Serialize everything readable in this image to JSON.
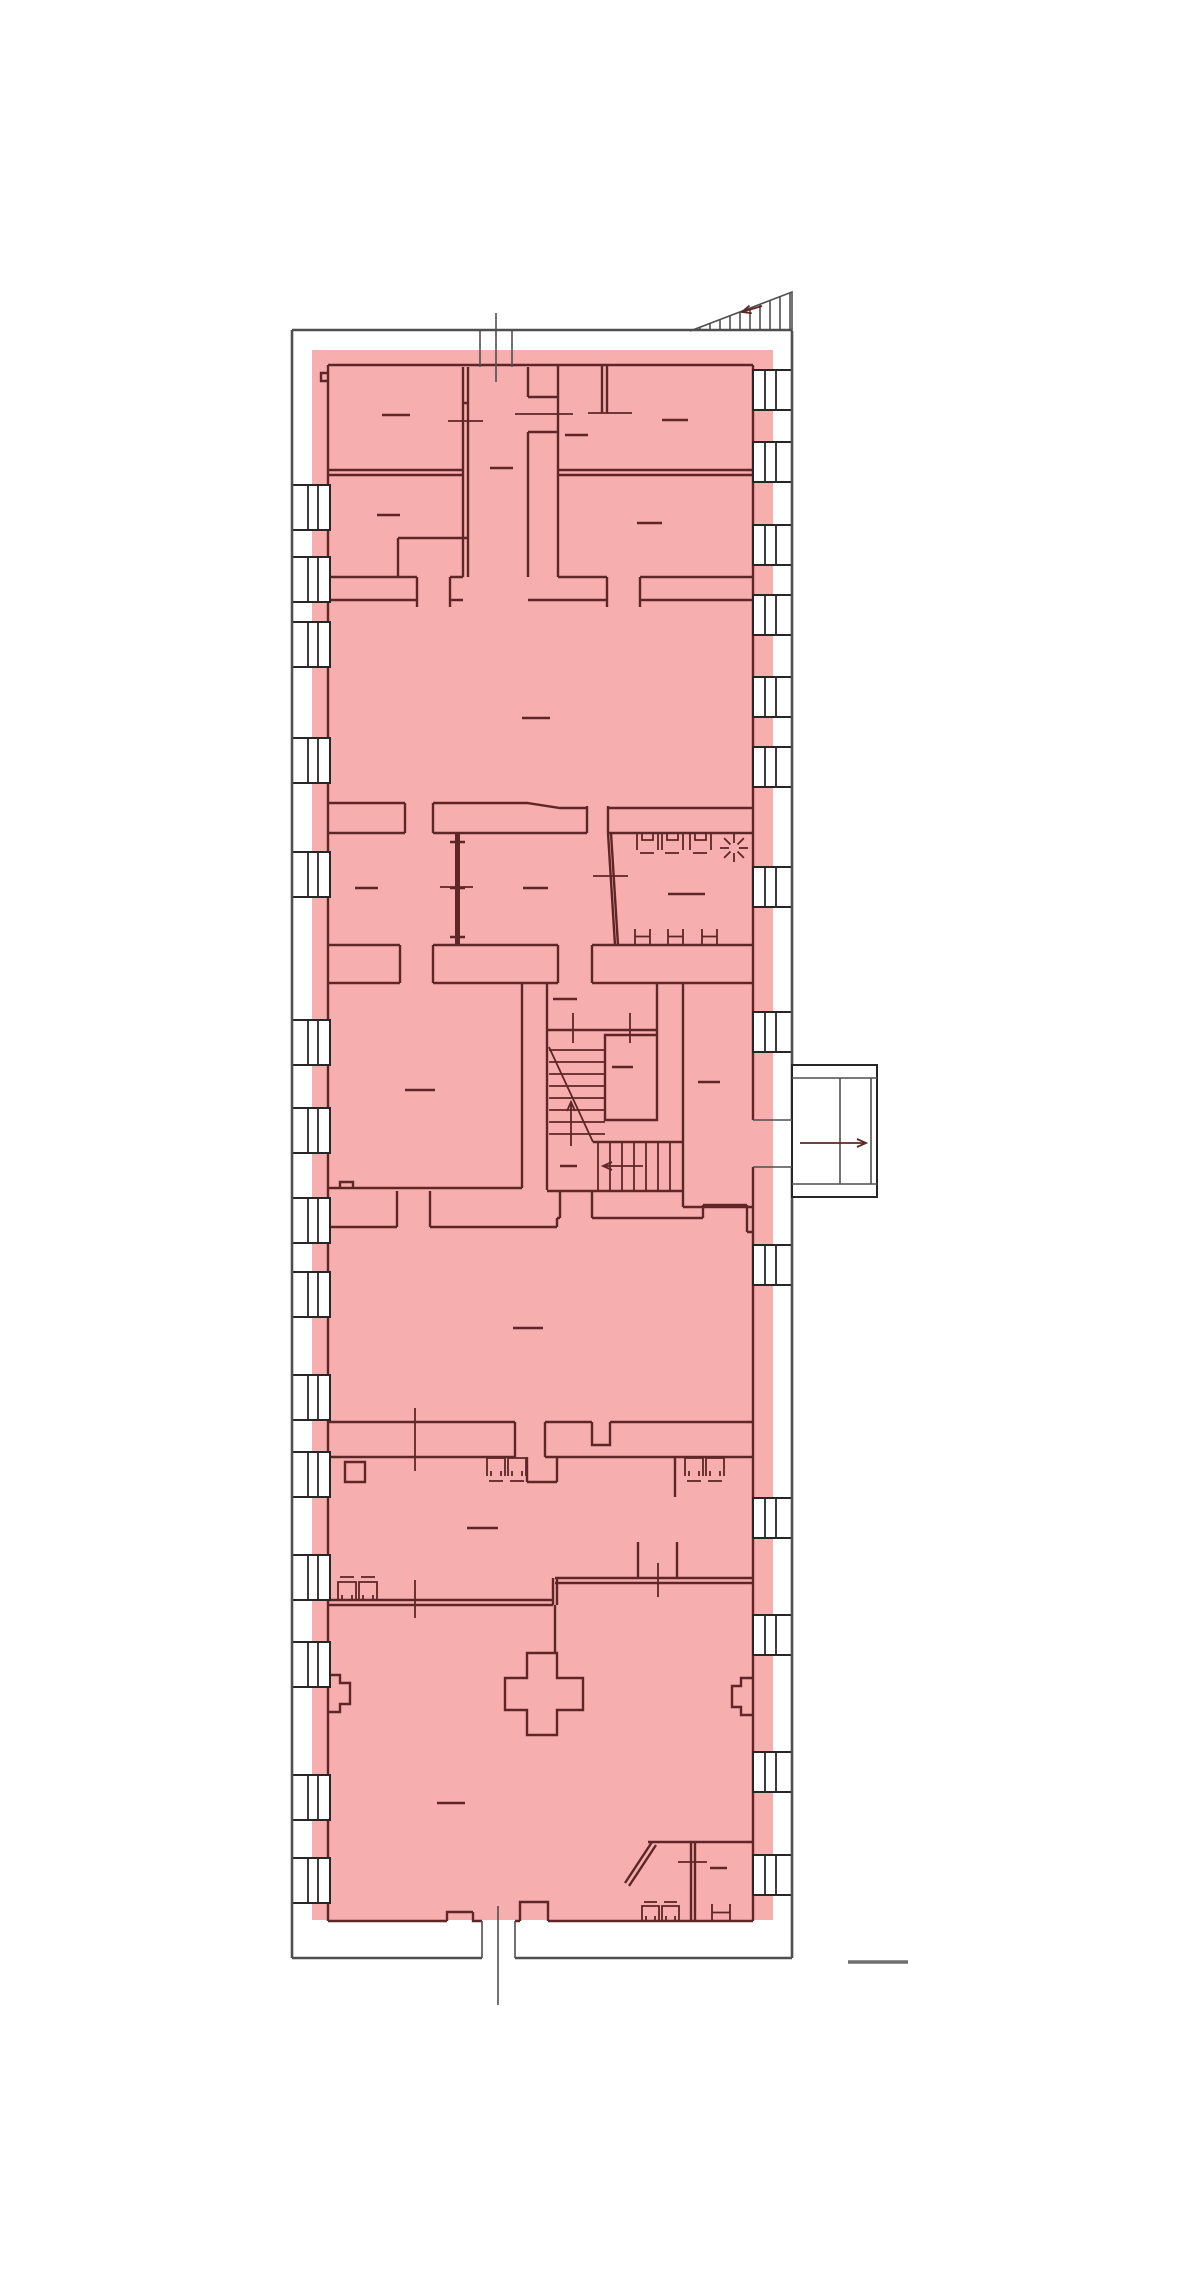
{
  "document": {
    "type": "architectural-floor-plan",
    "description": "single-storey floor plan with highlighted (selected) floor area, no readable text labels",
    "visible_text": []
  },
  "colors": {
    "bg": "#ffffff",
    "highlight": "#f7aeae",
    "wall": "#5e2626",
    "outline": "#4f4f4f",
    "win_line": "#262626",
    "scale_line": "#6e6e6e"
  },
  "highlight_overlay": {
    "x": 312,
    "y": 350,
    "w": 461,
    "h": 1570
  },
  "windows": {
    "left": {
      "x": 292,
      "w": 38,
      "h": 45,
      "mullions": [
        308,
        318
      ],
      "tops": [
        485,
        557,
        622,
        738,
        852,
        1020,
        1108,
        1198,
        1272,
        1375,
        1452,
        1555,
        1642,
        1775,
        1858
      ]
    },
    "right": {
      "x": 753,
      "w": 39,
      "h": 40,
      "mullions": [
        765,
        776
      ],
      "tops": [
        370,
        442,
        525,
        595,
        677,
        747,
        867,
        1012,
        1245,
        1498,
        1615,
        1752,
        1855
      ]
    }
  },
  "room_label_dashes": [
    [
      382,
      415,
      28
    ],
    [
      565,
      435,
      23
    ],
    [
      662,
      420,
      26
    ],
    [
      377,
      515,
      23
    ],
    [
      637,
      523,
      25
    ],
    [
      490,
      468,
      23
    ],
    [
      522,
      718,
      28
    ],
    [
      355,
      888,
      23
    ],
    [
      523,
      888,
      25
    ],
    [
      668,
      894,
      37
    ],
    [
      405,
      1090,
      30
    ],
    [
      553,
      999,
      24
    ],
    [
      612,
      1067,
      21
    ],
    [
      560,
      1166,
      17
    ],
    [
      698,
      1082,
      22
    ],
    [
      513,
      1328,
      30
    ],
    [
      467,
      1528,
      31
    ],
    [
      437,
      1803,
      28
    ],
    [
      710,
      1868,
      17
    ]
  ],
  "door_marks": {
    "horizontal": [
      [
        448,
        421,
        35
      ],
      [
        515,
        414,
        58
      ],
      [
        588,
        413,
        44
      ],
      [
        440,
        887,
        33
      ],
      [
        593,
        876,
        35
      ],
      [
        678,
        1862,
        29
      ]
    ],
    "vertical": [
      [
        573,
        1013,
        30
      ],
      [
        630,
        1013,
        30
      ],
      [
        415,
        1408,
        63
      ],
      [
        658,
        1563,
        34
      ],
      [
        415,
        1580,
        38
      ]
    ]
  },
  "stair": {
    "upper_run_tread_ys": [
      1050,
      1062,
      1074,
      1086,
      1098,
      1110,
      1122,
      1134
    ],
    "upper_run_x": [
      549,
      605
    ],
    "diagonal": [
      549,
      1047,
      593,
      1142
    ],
    "lower_run_tread_xs": [
      598,
      610,
      622,
      634,
      646,
      658,
      670
    ],
    "lower_run_y": [
      1142,
      1190
    ],
    "up_arrow": {
      "x1": 571,
      "y1": 1146,
      "x2": 571,
      "y2": 1102
    },
    "exit_arrow": {
      "x1": 643,
      "y1": 1166,
      "x2": 603,
      "y2": 1166
    }
  },
  "exterior_stair_top": {
    "base_y": 331,
    "x1": 690,
    "x2": 792,
    "apex_y": 292,
    "tread_xs": [
      700,
      710,
      720,
      730,
      740,
      750,
      760,
      770,
      780,
      790
    ],
    "arrow": {
      "x1": 762,
      "y1": 306,
      "x2": 742,
      "y2": 312
    }
  },
  "exterior_landing": {
    "x": 792,
    "y": 1065,
    "w": 85,
    "h": 132,
    "band_ys": [
      1078,
      1184
    ],
    "divider_xs": [
      840,
      871
    ],
    "door_jamb_ys": [
      1120,
      1167
    ],
    "arrow": {
      "x1": 800,
      "y1": 1143,
      "x2": 866,
      "y2": 1143
    }
  },
  "fixtures": {
    "toilet_stalls": {
      "y": 834,
      "h": 16,
      "w": 21,
      "xs": [
        637,
        662,
        690
      ],
      "dash_y": 853
    },
    "sun_symbol": {
      "cx": 734,
      "cy": 848,
      "r_in": 5,
      "r_out": 14
    },
    "h_marks": [
      [
        635,
        929,
        15,
        15
      ],
      [
        668,
        929,
        15,
        15
      ],
      [
        702,
        929,
        15,
        15
      ],
      [
        712,
        1904,
        18,
        17
      ]
    ],
    "sinks_top": {
      "y": 1458,
      "h": 18,
      "w": 18,
      "xs": [
        487,
        508,
        685,
        706
      ],
      "dash_y": 1481
    },
    "sinks_bottom": {
      "y": 1582,
      "h": 18,
      "w": 18,
      "xs": [
        338,
        359
      ],
      "dash_y": 1577
    },
    "sinks_wc": {
      "y": 1906,
      "h": 15,
      "w": 17,
      "xs": [
        642,
        662
      ],
      "dash_y": 1902
    }
  },
  "section_markers": {
    "top": {
      "jamb_xs": [
        480,
        512
      ],
      "jamb_y": [
        330,
        367
      ],
      "center_x": 496,
      "center_y": [
        313,
        382
      ]
    },
    "bottom": {
      "jamb_xs": [
        482,
        515
      ],
      "jamb_y": [
        1921,
        1958
      ],
      "center_x": 498,
      "center_y": [
        1906,
        2005
      ]
    }
  },
  "scale_line": {
    "x1": 848,
    "y1": 1962,
    "x2": 908,
    "y2": 1962
  }
}
